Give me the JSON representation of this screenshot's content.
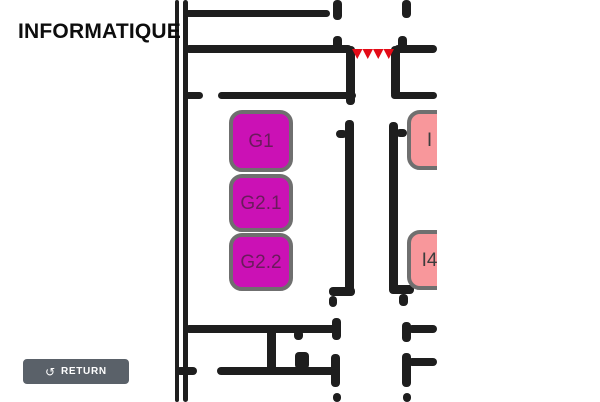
{
  "header": {
    "title": "INFORMATIQUE"
  },
  "controls": {
    "return_button": {
      "icon": "↺",
      "label": "RETURN"
    }
  },
  "colors": {
    "wall": "#1e1e1e",
    "highlight_fill": "#cb11b5",
    "highlight_text": "#6b1a5c",
    "room_border": "#6f6f6f",
    "pink_fill": "#f8979b",
    "pink_text": "#3d3d3d",
    "stairs": "#e30b17",
    "button_bg": "#5a6169",
    "button_text": "#ffffff",
    "title_text": "#0d0d0d"
  },
  "map": {
    "clip_width": 437,
    "highlight_rooms": [
      {
        "label": "G1",
        "x": 229,
        "y": 110,
        "w": 64,
        "h": 62
      },
      {
        "label": "G2.1",
        "x": 229,
        "y": 174,
        "w": 64,
        "h": 58
      },
      {
        "label": "G2.2",
        "x": 229,
        "y": 233,
        "w": 64,
        "h": 58
      }
    ],
    "pink_rooms": [
      {
        "label": "I",
        "x": 407,
        "y": 110,
        "w": 45,
        "h": 60
      },
      {
        "label": "I4",
        "x": 407,
        "y": 230,
        "w": 45,
        "h": 60
      }
    ],
    "stairs_marker": {
      "x": 352,
      "y": 49,
      "w": 42,
      "h": 10,
      "teeth": 4
    },
    "walls": [
      [
        175,
        0,
        4,
        402
      ],
      [
        183,
        0,
        5,
        402
      ],
      [
        185,
        10,
        145,
        7
      ],
      [
        185,
        45,
        167,
        8
      ],
      [
        394,
        45,
        43,
        8
      ],
      [
        333,
        0,
        9,
        20
      ],
      [
        402,
        0,
        9,
        18
      ],
      [
        333,
        36,
        9,
        13
      ],
      [
        398,
        36,
        9,
        13
      ],
      [
        346,
        46,
        9,
        59
      ],
      [
        391,
        46,
        9,
        52
      ],
      [
        185,
        92,
        18,
        7
      ],
      [
        218,
        92,
        138,
        7
      ],
      [
        391,
        92,
        46,
        7
      ],
      [
        345,
        120,
        9,
        176
      ],
      [
        389,
        122,
        9,
        170
      ],
      [
        336,
        130,
        11,
        8
      ],
      [
        396,
        129,
        11,
        8
      ],
      [
        329,
        287,
        26,
        9
      ],
      [
        329,
        296,
        8,
        11
      ],
      [
        389,
        285,
        25,
        9
      ],
      [
        399,
        294,
        9,
        12
      ],
      [
        185,
        325,
        152,
        8
      ],
      [
        332,
        318,
        9,
        22
      ],
      [
        294,
        330,
        9,
        10
      ],
      [
        176,
        367,
        21,
        8
      ],
      [
        217,
        367,
        120,
        8
      ],
      [
        331,
        354,
        9,
        33
      ],
      [
        295,
        352,
        14,
        17
      ],
      [
        267,
        328,
        9,
        45
      ],
      [
        402,
        322,
        9,
        20
      ],
      [
        408,
        325,
        29,
        8
      ],
      [
        402,
        353,
        9,
        34
      ],
      [
        408,
        358,
        29,
        8
      ],
      [
        333,
        393,
        8,
        9
      ],
      [
        403,
        393,
        8,
        9
      ]
    ]
  }
}
